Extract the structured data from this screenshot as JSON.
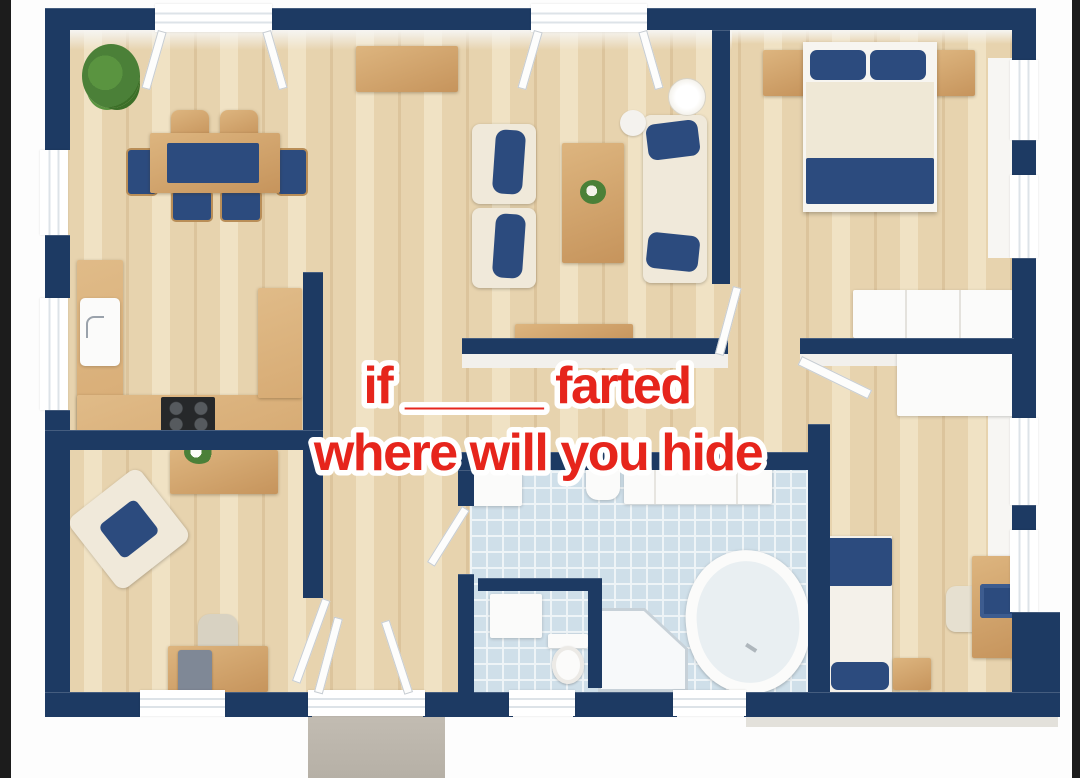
{
  "meme_caption": {
    "line1": "if _____ farted",
    "line2": "where will you hide",
    "text_color": "#e6251c",
    "outline_color": "#ffffff"
  },
  "palette": {
    "wall_navy": "#1d3a63",
    "floor_wood": "#e7d3ae",
    "floor_wood_dark": "#dcc49c",
    "floor_wood_light": "#f0e2c4",
    "counter_wood": "#d7ab74",
    "furniture_wood": "#cfa069",
    "fabric_navy": "#2c4b7e",
    "upholstery_cream": "#f0e9da",
    "bath_tile": "#cfdfe9",
    "tile_grid": "#eef4f7",
    "fixture_white": "#fbfbfa",
    "porch_concrete": "#b6b0a6",
    "edge_black": "#1c1c1c",
    "appliance_black": "#26282a",
    "plant_green": "#4b8038"
  },
  "floorplan": {
    "type": "3d-floor-plan-top-view",
    "rooms": [
      {
        "name": "dining-room",
        "furniture": [
          "potted-plant",
          "dining-table",
          "dining-chairs-x6",
          "sideboard"
        ]
      },
      {
        "name": "living-room",
        "furniture": [
          "armchair",
          "armchair",
          "coffee-table",
          "sofa",
          "floor-lamp",
          "side-table",
          "tv-bench"
        ]
      },
      {
        "name": "master-bedroom",
        "furniture": [
          "double-bed",
          "nightstand",
          "nightstand",
          "wardrobe",
          "window-sill-shelf"
        ]
      },
      {
        "name": "kitchen",
        "furniture": [
          "u-shaped-counter",
          "kitchen-sink",
          "cooktop"
        ]
      },
      {
        "name": "office-room",
        "furniture": [
          "console-table",
          "tilted-armchair",
          "desk",
          "desk-chair",
          "computer-tower"
        ]
      },
      {
        "name": "bathroom",
        "furniture": [
          "washing-machine",
          "wall-sink",
          "vanity-counter",
          "toilet",
          "corner-shower",
          "bathtub"
        ]
      },
      {
        "name": "small-bedroom",
        "furniture": [
          "single-bed",
          "nightstand",
          "desk",
          "desk-chair",
          "laptop"
        ]
      },
      {
        "name": "hallway",
        "furniture": []
      }
    ]
  }
}
